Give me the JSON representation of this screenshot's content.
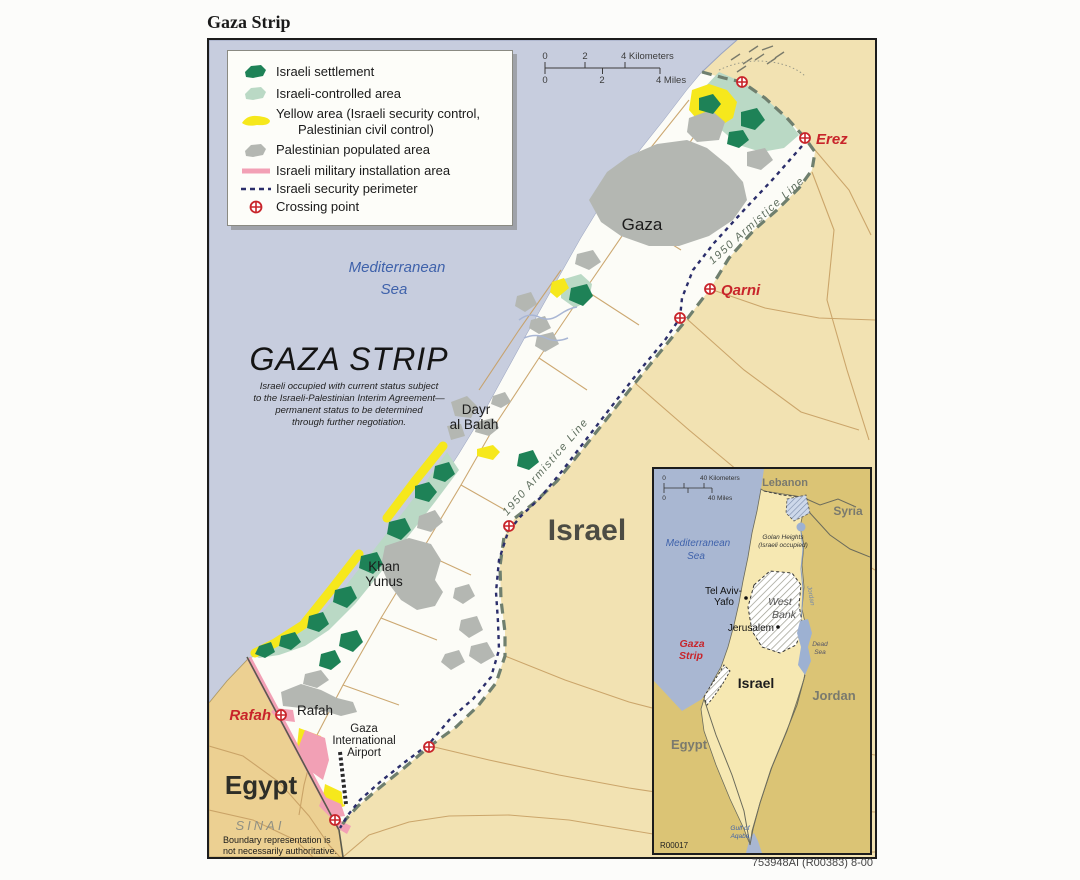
{
  "page": {
    "title": "Gaza Strip",
    "credit": "753948AI (R00383) 8-00"
  },
  "colors": {
    "sea": "#c7cdde",
    "israel_land": "#f2e2b2",
    "egypt_land": "#ecd092",
    "strip_interior": "#fcfcf7",
    "israeli_settlement": "#1e8257",
    "israeli_controlled": "#bad9c5",
    "yellow_area": "#f6e81c",
    "palestinian_populated": "#b4b7b2",
    "military_installation": "#f2a0b5",
    "security_perimeter": "#2b2e6b",
    "armistice_line": "#6f7f6e",
    "crossing_accent": "#c8242a",
    "water_label": "#3f62ab"
  },
  "legend": {
    "items": [
      {
        "swatch": "israeli-settlement-swatch",
        "label": "Israeli settlement"
      },
      {
        "swatch": "israeli-controlled-area-swatch",
        "label": "Israeli-controlled area"
      },
      {
        "swatch": "yellow-area-swatch",
        "label": "Yellow area (Israeli security control,",
        "label2": "Palestinian civil control)"
      },
      {
        "swatch": "palestinian-populated-area-swatch",
        "label": "Palestinian populated area"
      },
      {
        "swatch": "israeli-military-installation-swatch",
        "label": "Israeli military installation area"
      },
      {
        "swatch": "israeli-security-perimeter-swatch",
        "label": "Israeli security perimeter"
      },
      {
        "swatch": "crossing-point-swatch",
        "label": "Crossing point"
      }
    ]
  },
  "scalebar": {
    "km0": "0",
    "km2": "2",
    "km4": "4 Kilometers",
    "mi0": "0",
    "mi2": "2",
    "mi4": "4 Miles"
  },
  "map_labels": {
    "sea1": "Mediterranean",
    "sea2": "Sea",
    "region": "GAZA STRIP",
    "note1": "Israeli occupied with current status subject",
    "note2": "to the Israeli-Palestinian Interim Agreement—",
    "note3": "permanent status to be determined",
    "note4": "through further negotiation.",
    "gaza": "Gaza",
    "dayr1": "Dayr",
    "dayr2": "al Balah",
    "khan1": "Khan",
    "khan2": "Yunus",
    "rafah_town": "Rafah",
    "rafah_crossing": "Rafah",
    "erez": "Erez",
    "qarni": "Qarni",
    "israel": "Israel",
    "egypt": "Egypt",
    "sinai": "SINAI",
    "airport1": "Gaza",
    "airport2": "International",
    "airport3": "Airport",
    "armistice1": "1950  Armistice  Line",
    "armistice2": "1950  Armistice  Line",
    "boundary1": "Boundary representation is",
    "boundary2": "not necessarily authoritative."
  },
  "inset": {
    "scale": {
      "km_zero": "0",
      "km": "40 Kilometers",
      "mi_zero": "0",
      "mi": "40 Miles"
    },
    "ref": "R00017",
    "labels": {
      "lebanon": "Lebanon",
      "syria": "Syria",
      "golan1": "Golan Heights",
      "golan2": "(Israeli occupied)",
      "med1": "Mediterranean",
      "med2": "Sea",
      "telaviv1": "Tel Aviv-",
      "telaviv2": "Yafo",
      "westbank1": "West",
      "westbank2": "Bank",
      "jerusalem": "Jerusalem",
      "jordan_river": "Jordan",
      "deadsea1": "Dead",
      "deadsea2": "Sea",
      "gaza1": "Gaza",
      "gaza2": "Strip",
      "israel": "Israel",
      "jordan": "Jordan",
      "egypt": "Egypt",
      "gulf1": "Gulf of",
      "gulf2": "Aqaba"
    }
  }
}
